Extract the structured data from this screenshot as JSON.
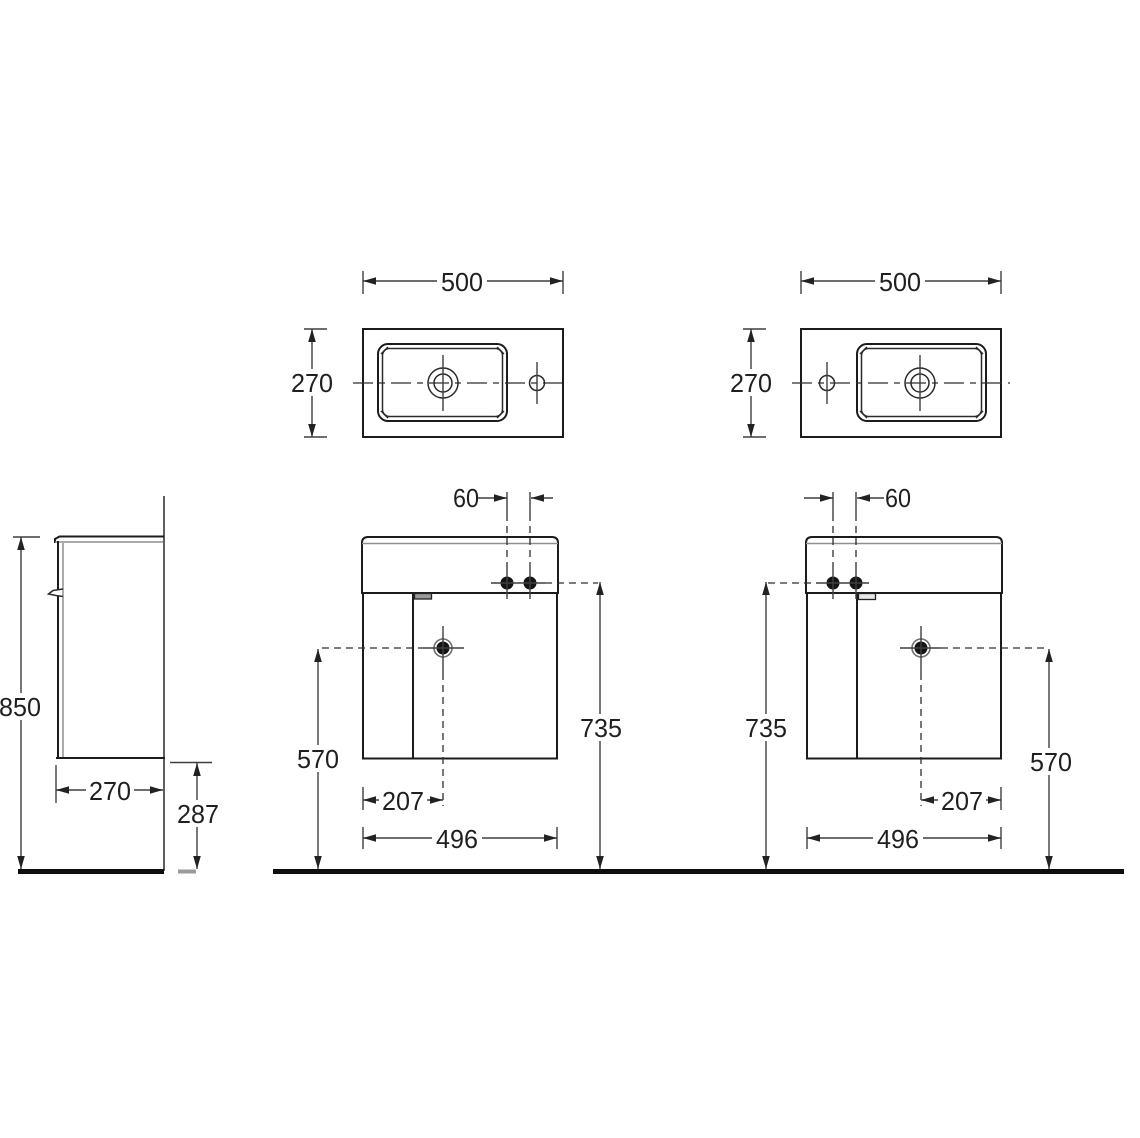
{
  "drawing": {
    "title": "wall-hung-vanity-unit-technical-drawing",
    "units": "mm",
    "colors": {
      "object_line": "#1c1c1c",
      "dimension_line": "#3f3f3f",
      "floor_line": "#0e0e0e",
      "background": "#ffffff"
    },
    "views": {
      "side": {
        "labels": {
          "overall_height": "850",
          "depth": "270",
          "underside_clearance": "287"
        }
      },
      "top_left": {
        "labels": {
          "width": "500",
          "depth": "270"
        }
      },
      "top_right": {
        "labels": {
          "width": "500",
          "depth": "270"
        }
      },
      "front_left": {
        "labels": {
          "tap_hole_spacing": "60",
          "fixing_height": "735",
          "outlet_height": "570",
          "outlet_offset": "207",
          "cabinet_width": "496"
        }
      },
      "front_right": {
        "labels": {
          "tap_hole_spacing": "60",
          "fixing_height": "735",
          "outlet_height": "570",
          "outlet_offset": "207",
          "cabinet_width": "496"
        }
      }
    }
  }
}
